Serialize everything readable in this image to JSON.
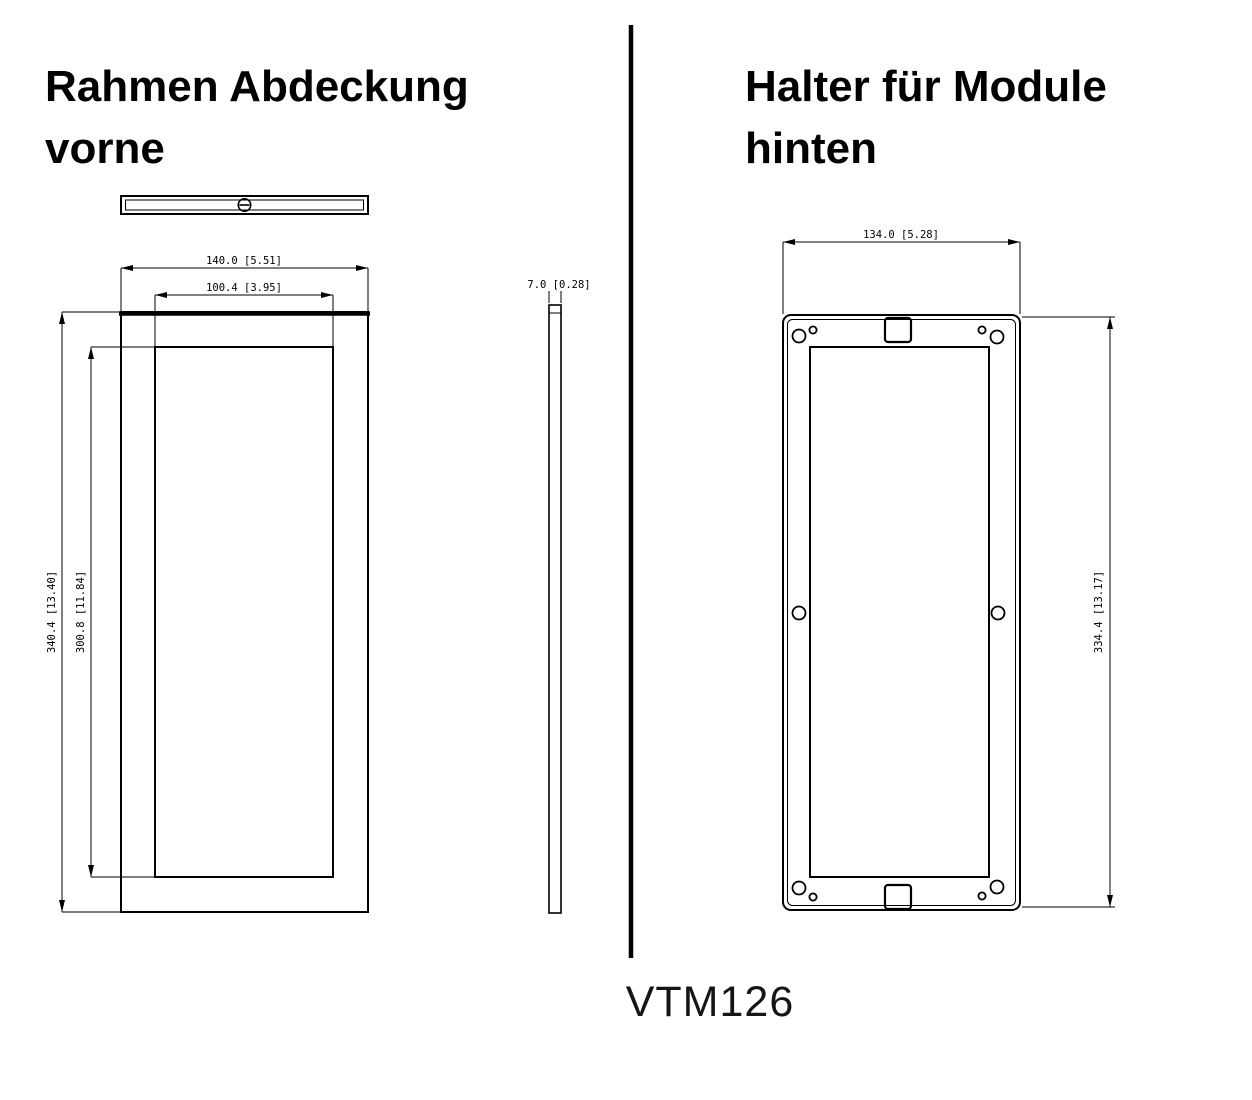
{
  "product_code": "VTM126",
  "left_panel": {
    "title_line1": "Rahmen Abdeckung",
    "title_line2": "vorne",
    "dim_outer_width": "140.0 [5.51]",
    "dim_inner_width": "100.4 [3.95]",
    "dim_outer_height": "340.4 [13.40]",
    "dim_inner_height": "300.8 [11.84]",
    "dim_thickness": "7.0 [0.28]"
  },
  "right_panel": {
    "title_line1": "Halter für Module",
    "title_line2": "hinten",
    "dim_width": "134.0 [5.28]",
    "dim_height": "334.4 [13.17]"
  },
  "colors": {
    "line": "#000000",
    "background": "#ffffff",
    "text": "#000000"
  }
}
